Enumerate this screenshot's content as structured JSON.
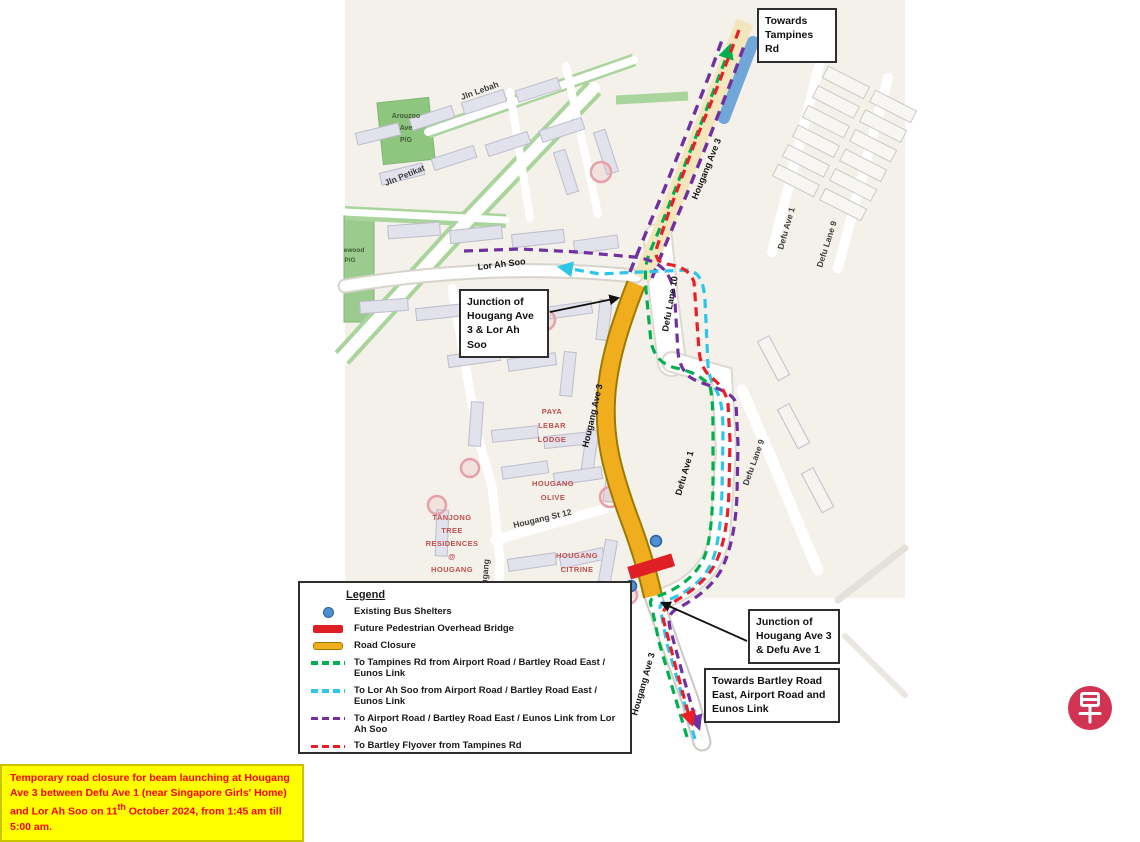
{
  "notice": {
    "part1": "Temporary road closure for beam launching at Hougang Ave 3 between Defu Ave 1 (near Singapore Girls' Home) and Lor Ah Soo on 11",
    "sup": "th",
    "part2": " October 2024, from 1:45 am till 5:00 am."
  },
  "callout_boxes": {
    "towards_tampines": "Towards Tampines Rd",
    "junction_lor_ah_soo": "Junction of Hougang Ave 3 & Lor Ah Soo",
    "junction_defu": "Junction of Hougang Ave 3 & Defu Ave 1",
    "towards_bartley": "Towards Bartley Road East, Airport Road and Eunos Link"
  },
  "legend": {
    "title": "Legend",
    "items": [
      {
        "label": "Existing Bus Shelters"
      },
      {
        "label": "Future Pedestrian Overhead Bridge"
      },
      {
        "label": "Road Closure"
      },
      {
        "label": "To Tampines Rd from Airport Road / Bartley Road East / Eunos Link"
      },
      {
        "label": "To Lor Ah Soo from Airport Road / Bartley Road East / Eunos Link"
      },
      {
        "label": "To Airport Road / Bartley Road East / Eunos Link from Lor Ah Soo"
      },
      {
        "label": "To Bartley Flyover from Tampines Rd"
      }
    ]
  },
  "map_labels": {
    "streets": {
      "lor_ah_soo": "Lor Ah Soo",
      "defu_lane_10": "Defu Lane 10",
      "defu_ave_1_upper": "Defu Ave 1",
      "defu_lane_9_upper": "Defu Lane 9",
      "defu_ave_1_mid": "Defu Ave 1",
      "defu_lane_9_mid": "Defu Lane 9",
      "jln_petikat": "Jln Petikat",
      "jln_lebah": "Jln Lebah",
      "hougang_st_12": "Hougang St 12",
      "hougang_partial": "Hougang",
      "hougang_ave_3": "Hougang Ave 3"
    },
    "places": {
      "arouzoo_pg": [
        "Arouzoo",
        "Ave",
        "P/G"
      ],
      "ewood_pg": [
        "ewood",
        "P/G"
      ],
      "paya_lebar_lodge": [
        "PAYA",
        "LEBAR",
        "LODGE"
      ],
      "hougang_olive": [
        "HOUGANG",
        "OLIVE"
      ],
      "tanjong_tree": [
        "TANJONG",
        "TREE",
        "RESIDENCES",
        "@",
        "HOUGANG"
      ],
      "hougang_citrine": [
        "HOUGANG",
        "CITRINE"
      ]
    }
  },
  "colors": {
    "route_to_tampines_green": "#00B050",
    "route_to_lor_ah_soo_cyan": "#2EC6E8",
    "route_to_airport_purple": "#7030A0",
    "route_to_bartley_red": "#EE1C25",
    "road_closure_yellow": "#F0AD1E",
    "bridge_red": "#DF1E26",
    "bus_shelter_blue": "#4D8FD1",
    "notice_bg_yellow": "#FFFF00",
    "notice_text_red": "#FF0000",
    "logo_red": "#D23352"
  },
  "logo": {
    "char": "早"
  }
}
